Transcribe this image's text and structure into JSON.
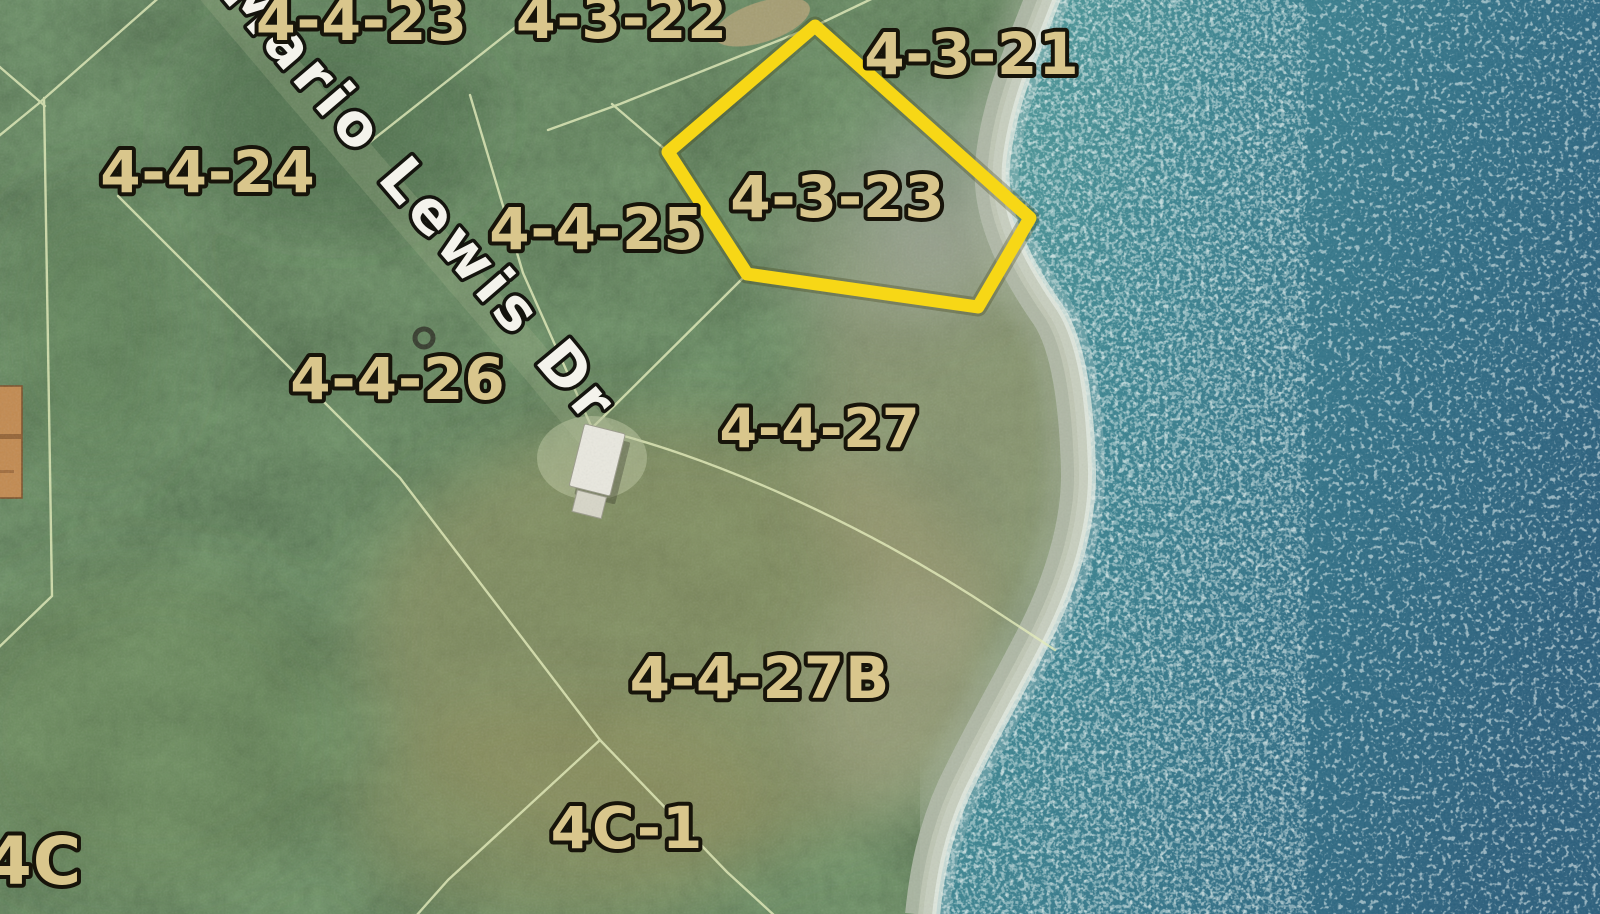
{
  "map": {
    "type": "satellite-cadastral-parcel-map",
    "road_label": "Mario Lewis Dr",
    "highlighted_parcel": {
      "id": "4-3-23",
      "outline_color": "#f7d716",
      "points": "815,26 1030,218 978,307 747,274 668,152"
    },
    "parcel_labels": [
      {
        "text": "4-4-23",
        "x": 362,
        "y": 40,
        "size": 57
      },
      {
        "text": "4-3-22",
        "x": 622,
        "y": 38,
        "size": 57
      },
      {
        "text": "4-3-21",
        "x": 972,
        "y": 74,
        "size": 58
      },
      {
        "text": "4-4-24",
        "x": 208,
        "y": 192,
        "size": 58
      },
      {
        "text": "4-4-25",
        "x": 597,
        "y": 249,
        "size": 58
      },
      {
        "text": "4-3-23",
        "x": 838,
        "y": 217,
        "size": 58
      },
      {
        "text": "4-4-26",
        "x": 398,
        "y": 399,
        "size": 58
      },
      {
        "text": "4-4-27",
        "x": 820,
        "y": 447,
        "size": 54
      },
      {
        "text": "4-4-27B",
        "x": 760,
        "y": 698,
        "size": 58
      },
      {
        "text": "4C-1",
        "x": 627,
        "y": 848,
        "size": 58
      },
      {
        "text": "4C",
        "x": 34,
        "y": 884,
        "size": 66
      }
    ],
    "colors": {
      "highlight_outline": "#f7d716",
      "parcel_label": "#d9c68c",
      "parcel_label_outline": "#17140a",
      "road_label_text": "#f4f3ec",
      "parcel_line": "#e6efbc",
      "land_green": "#4c6b4a",
      "coast_rock": "#b4bcab",
      "ocean_near_shore": "#4e9a9b",
      "ocean_deep": "#2a5f7e",
      "surf_white": "#e6eee6",
      "building_white": "#e9e8df",
      "building_tan": "#c28a50"
    }
  }
}
